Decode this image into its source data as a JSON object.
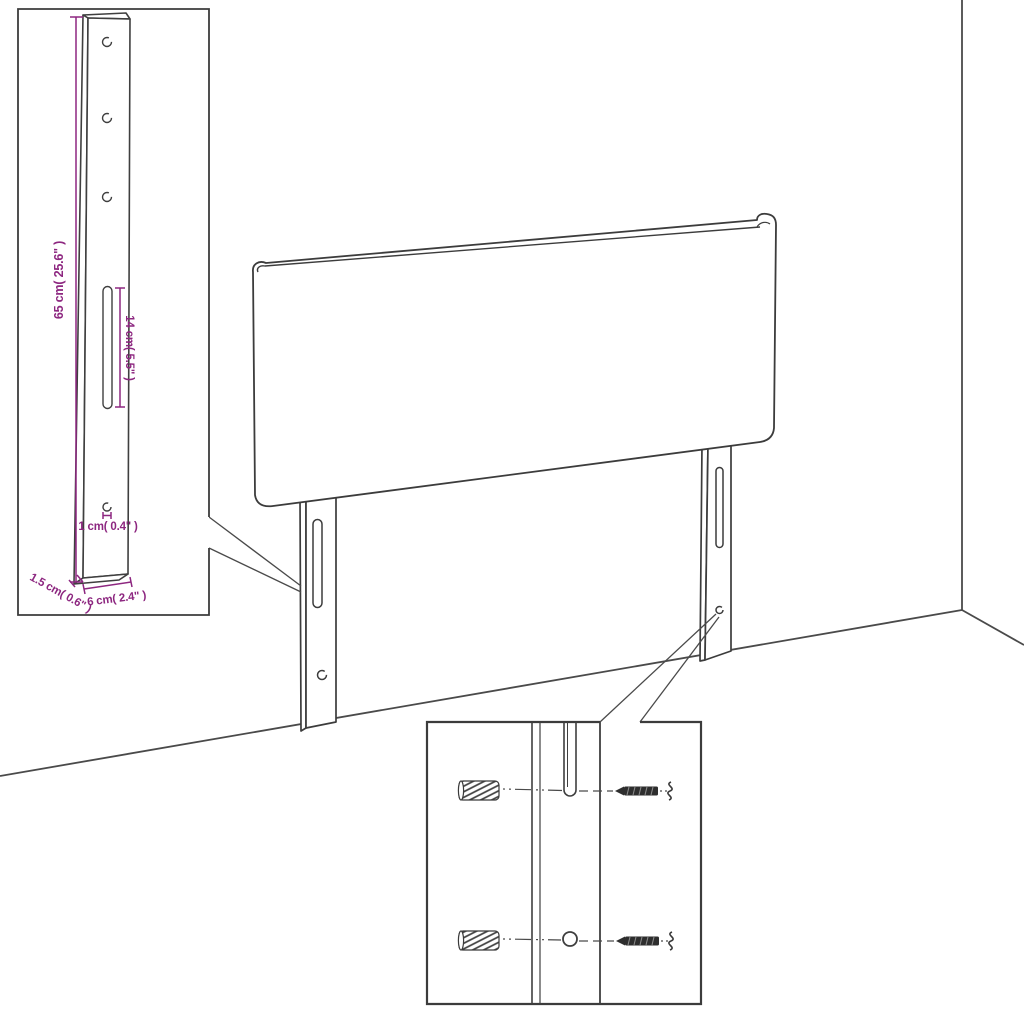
{
  "diagram": {
    "subject": "headboard-with-mounting-legs-assembly-diagram",
    "background_color": "#ffffff",
    "outline_color": "#3c3c3c",
    "dimension_color": "#8d2780",
    "leg_detail_inset": {
      "dim_height": "65 cm( 25.6\" )",
      "dim_slot_length": "14 cm( 5.5\" )",
      "dim_hole": "1 cm( 0.4\" )",
      "dim_thickness": "1.5 cm( 0.6\" )",
      "dim_width": "6 cm( 2.4\" )",
      "hole_count": 3
    },
    "main_view": {
      "parts": [
        "headboard-panel",
        "left-mounting-leg",
        "right-mounting-leg",
        "wall-corner",
        "floor-line"
      ]
    },
    "mounting_detail_inset": {
      "hardware": [
        "wall-plug",
        "screw"
      ],
      "wall_plug_count": 2,
      "screw_count": 2
    }
  }
}
